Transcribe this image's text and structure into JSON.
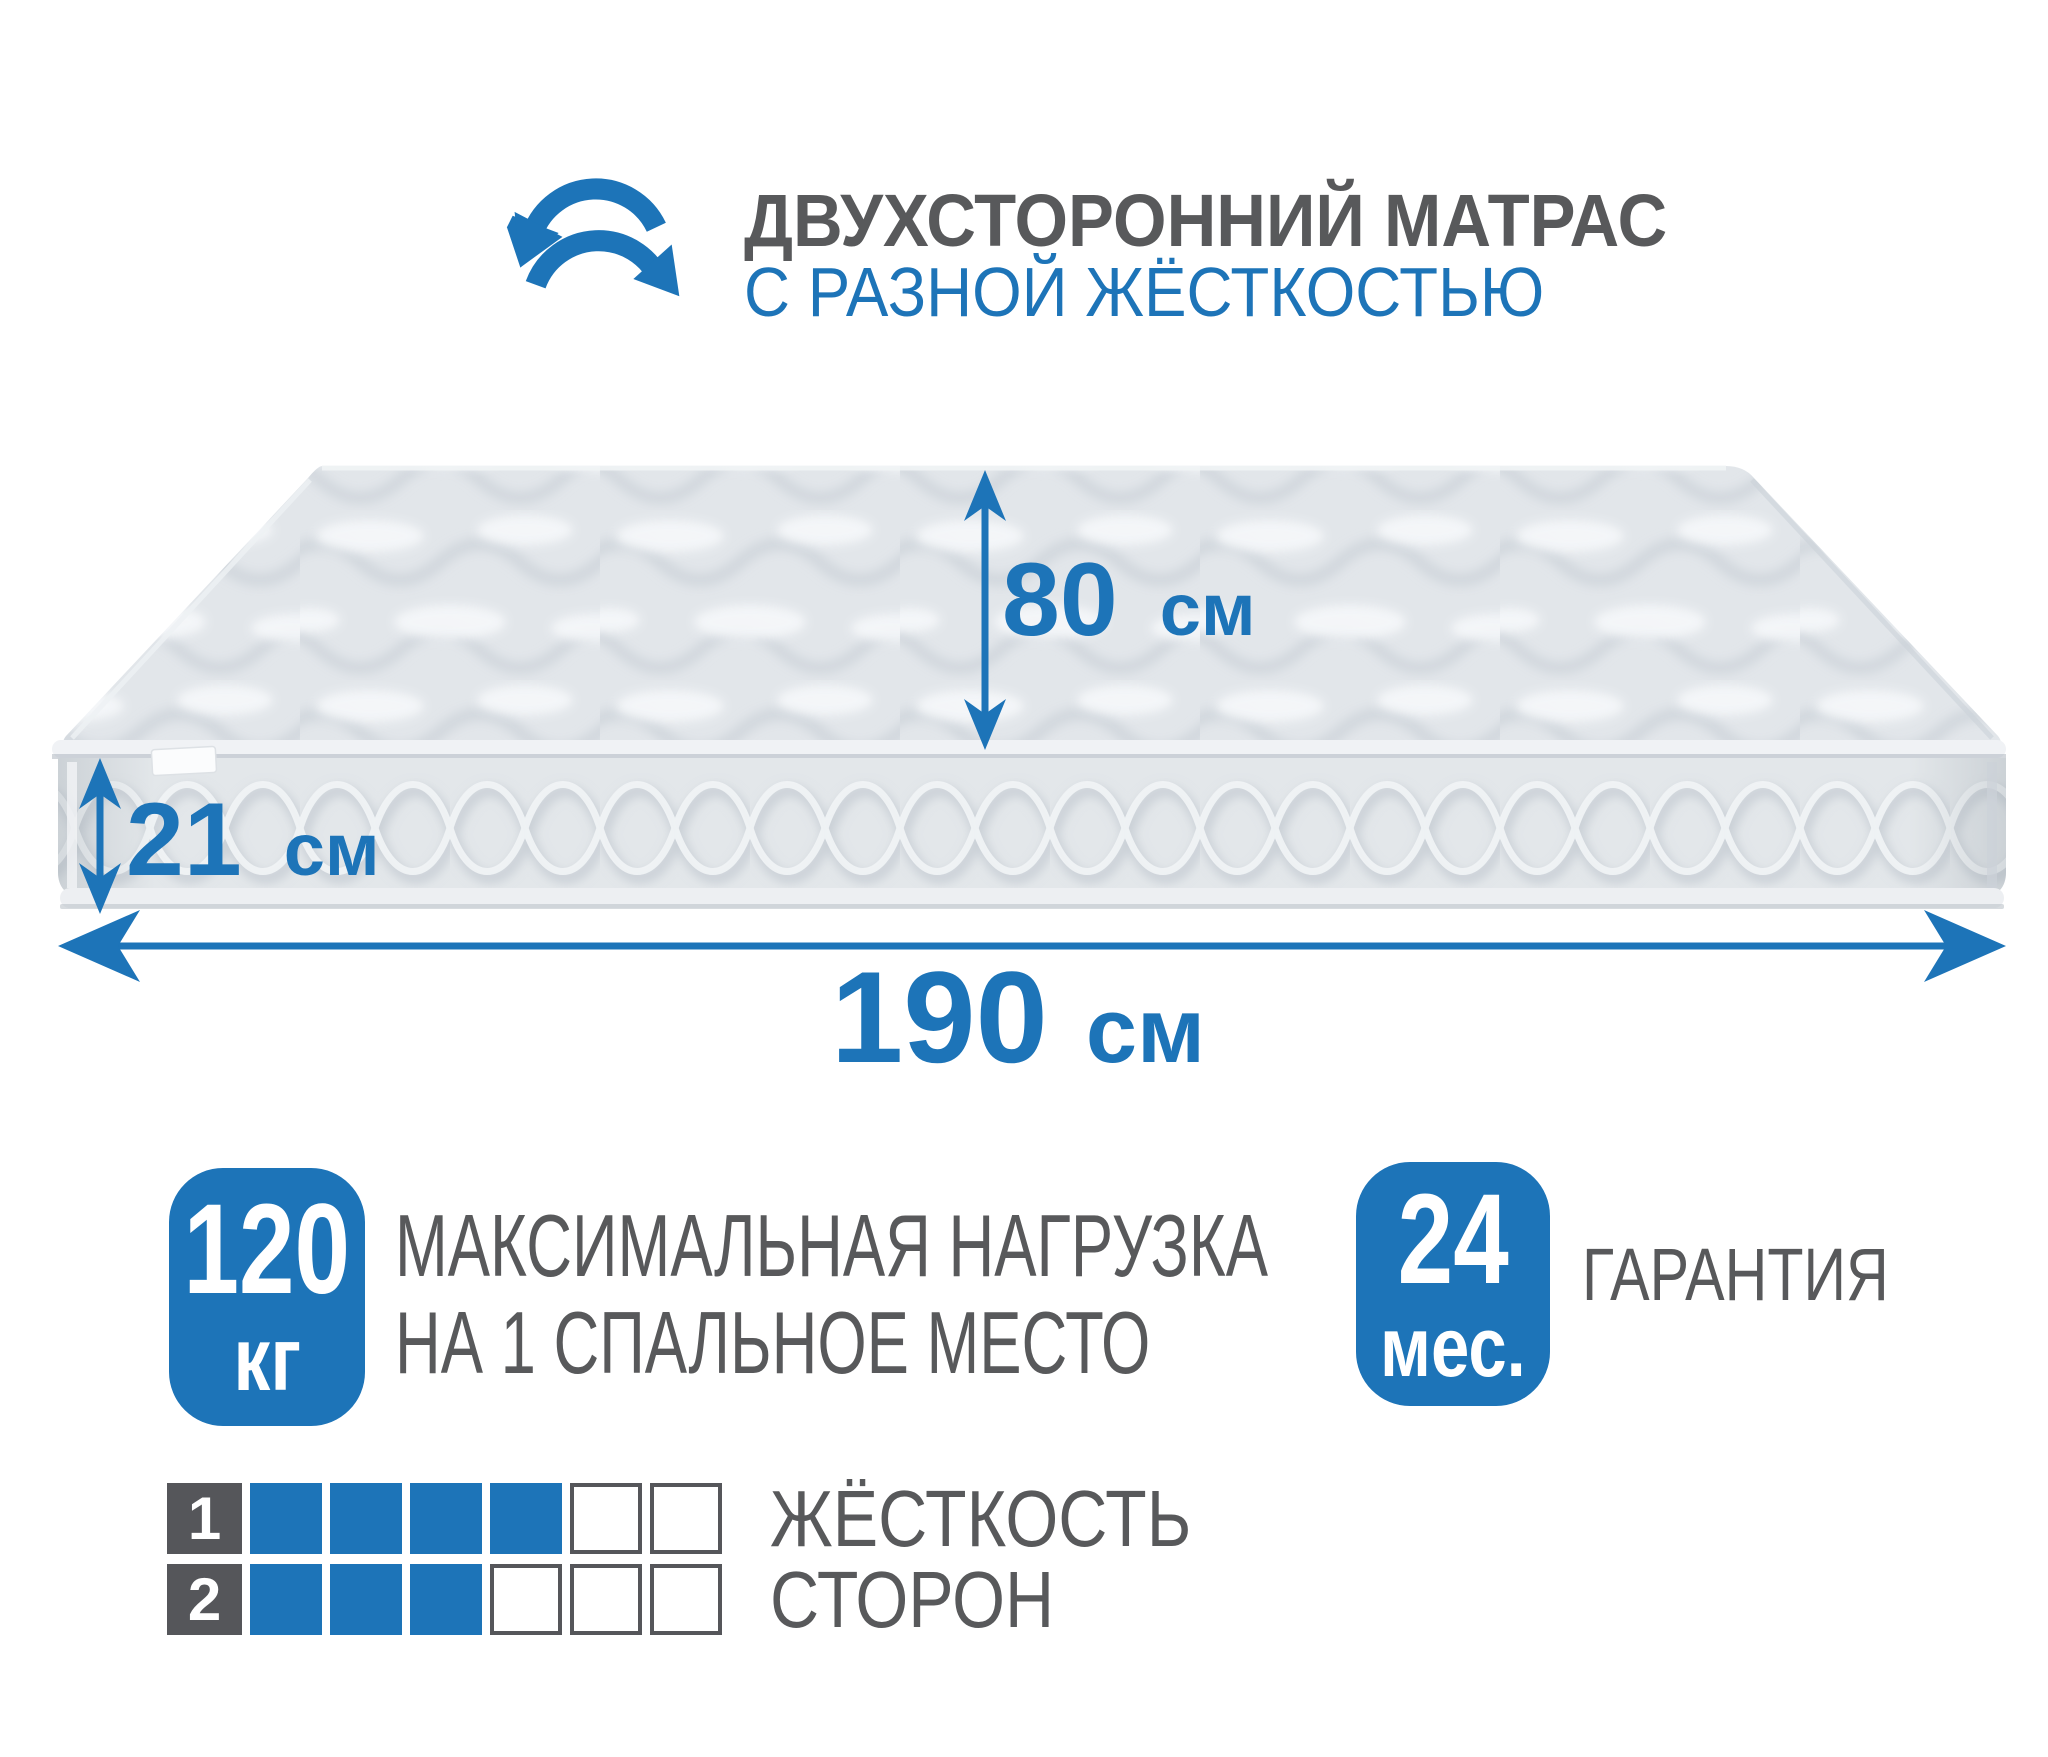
{
  "header": {
    "icon": "rotate-arrows-icon",
    "title": "ДВУХСТОРОННИЙ МАТРАС",
    "subtitle": "С РАЗНОЙ ЖЁСТКОСТЬЮ"
  },
  "dimensions": {
    "depth": {
      "value": "80",
      "unit": "см"
    },
    "height": {
      "value": "21",
      "unit": "см"
    },
    "length": {
      "value": "190",
      "unit": "см"
    }
  },
  "badges": {
    "max_load": {
      "value": "120",
      "unit": "кг",
      "label_line1": "МАКСИМАЛЬНАЯ НАГРУЗКА",
      "label_line2": "НА 1 СПАЛЬНОЕ МЕСТО"
    },
    "warranty": {
      "value": "24",
      "unit": "мес.",
      "label": "ГАРАНТИЯ"
    }
  },
  "firmness": {
    "caption_line1": "ЖЁСТКОСТЬ",
    "caption_line2": "СТОРОН",
    "scale_max": 6,
    "rows": [
      {
        "label": "1",
        "filled": 4
      },
      {
        "label": "2",
        "filled": 3
      }
    ]
  },
  "colors": {
    "accent_blue": "#1d74b8",
    "text_gray": "#58595b",
    "mattress_light": "#e2e6ea"
  }
}
